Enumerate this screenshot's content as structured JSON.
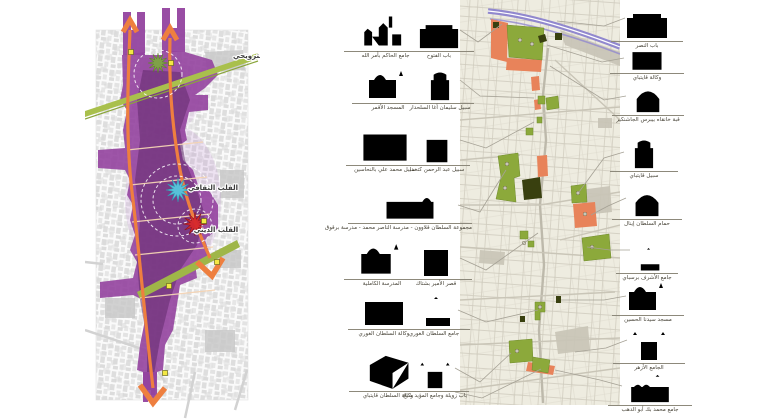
{
  "left_map": {
    "labels": {
      "leisure": "القلب الترويحي",
      "culture": "القلب الثقافي",
      "religion": "القلب الديني"
    },
    "colors": {
      "corridor": "#93439f",
      "corridor_core": "#5c2566",
      "pedestrian_axis": "#ee7f3f",
      "green_band": "#a9c04c",
      "leisure_star": "#7da93f",
      "culture_star": "#57c8dd",
      "religion_star": "#d6282c",
      "node_marker": "#f3e844"
    }
  },
  "right_map": {
    "colors": {
      "background": "#eeece0",
      "streets": "#c6c2b4",
      "city_wall": "#9188ce",
      "monument_green": "#8ca93b",
      "monument_dark": "#39400f",
      "intervention_orange": "#e8835a"
    }
  },
  "monuments_left": [
    {
      "label": "جامع الحاكم بأمر الله",
      "icon": "panorama-sketch-icon"
    },
    {
      "label": "باب الفتوح",
      "icon": "gate-sketch-icon"
    },
    {
      "label": "المسجد الأقمر",
      "icon": "mosque-sketch-icon"
    },
    {
      "label": "سبيل سليمان أغا السلحدار",
      "icon": "sabil-sketch-icon"
    },
    {
      "label": "سبيل محمد علي بالنحاسين",
      "icon": "facade-sketch-icon"
    },
    {
      "label": "سبيل عبد الرحمن كتخدا",
      "icon": "portal-sketch-icon"
    },
    {
      "label": "مجموعة السلطان قلاوون - مدرسة الناصر محمد - مدرسة برقوق",
      "icon": "complex-sketch-icon"
    },
    {
      "label": "المدرسة الكاملية",
      "icon": "mosque-sketch-icon"
    },
    {
      "label": "قصر الأمير بشتاك",
      "icon": "portal-sketch-icon"
    },
    {
      "label": "وكالة السلطان الغوري",
      "icon": "facade-sketch-icon"
    },
    {
      "label": "جامع السلطان الغوري",
      "icon": "minaret-sketch-icon"
    },
    {
      "label": "وكالة السلطان قايتباي",
      "icon": "courtyard-sketch-icon"
    },
    {
      "label": "باب زويلة وجامع المؤيد شيخ",
      "icon": "twin-minaret-gate-sketch-icon"
    }
  ],
  "monuments_right": [
    {
      "label": "باب النصر",
      "icon": "gate-sketch-icon"
    },
    {
      "label": "وكالة قايتباي",
      "icon": "facade-sketch-icon"
    },
    {
      "label": "قبة خانقاه بيبرس الجاشنكير",
      "icon": "dome-sketch-icon"
    },
    {
      "label": "سبيل قايتباي",
      "icon": "sabil-sketch-icon"
    },
    {
      "label": "حمام السلطان إينال",
      "icon": "dome-sketch-icon"
    },
    {
      "label": "جامع الأشرف برسباي",
      "icon": "minaret-sketch-icon"
    },
    {
      "label": "مسجد سيدنا الحسين",
      "icon": "mosque-sketch-icon"
    },
    {
      "label": "الجامع الأزهر",
      "icon": "twin-minaret-gate-sketch-icon"
    },
    {
      "label": "جامع محمد بك أبو الدهب",
      "icon": "big-mosque-sketch-icon"
    }
  ]
}
